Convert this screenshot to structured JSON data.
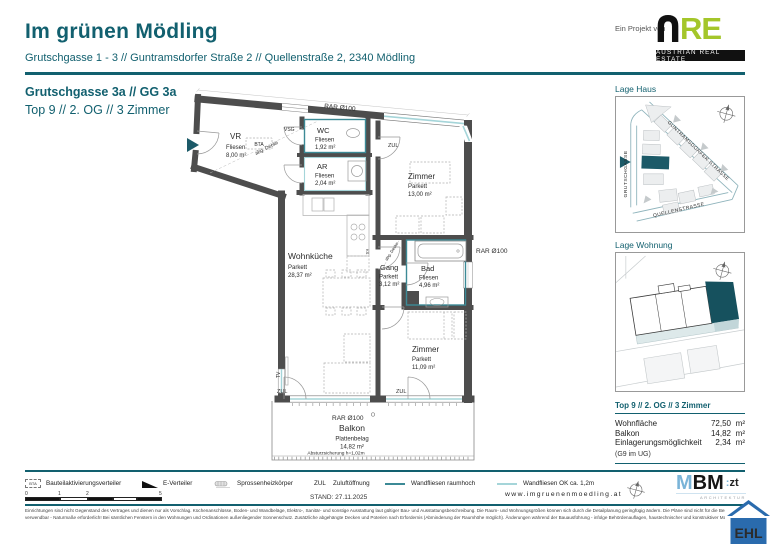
{
  "header": {
    "title": "Im grünen Mödling",
    "subtitle": "Grutschgasse 1 - 3 // Guntramsdorfer Straße 2 // Quellenstraße 2, 2340 Mödling",
    "project_note": "Ein Projekt von",
    "are_re": "RE",
    "are_caption": "AUSTRIAN REAL ESTATE"
  },
  "plan_header": {
    "address": "Grutschgasse 3a // GG 3a",
    "unit": "Top 9 // 2. OG // 3 Zimmer"
  },
  "floorplan": {
    "rooms": [
      {
        "name": "VR",
        "floor": "Fliesen",
        "area": "8,00 m²"
      },
      {
        "name": "WC",
        "floor": "Fliesen",
        "area": "1,92 m²"
      },
      {
        "name": "AR",
        "floor": "Fliesen",
        "area": "2,04 m²"
      },
      {
        "name": "Zimmer",
        "floor": "Parkett",
        "area": "13,00 m²"
      },
      {
        "name": "Wohnküche",
        "floor": "Parkett",
        "area": "28,37 m²"
      },
      {
        "name": "Gang",
        "floor": "Parkett",
        "area": "3,12 m²"
      },
      {
        "name": "Bad",
        "floor": "Fliesen",
        "area": "4,96 m²"
      },
      {
        "name": "Zimmer",
        "floor": "Parkett",
        "area": "11,09 m²"
      },
      {
        "name": "Balkon",
        "floor": "Plattenbelag",
        "area": "14,82 m²"
      }
    ],
    "labels": {
      "rar_top": "RAR Ø100",
      "rar_right": "RAR Ø100",
      "rar_balcony": "RAR Ø100",
      "vsg": "VSG",
      "bta": "BTA",
      "zul": "ZUL",
      "tv": "TV",
      "ks": "KS",
      "abg_decke": "abg. Decke",
      "absturz": "Absturzsicherung h=1,02m"
    }
  },
  "sidebar": {
    "lage_haus": {
      "title": "Lage Haus",
      "street_1": "GUNTRAMSDORFER STRASSE",
      "street_2": "GRUTSCHGASSE",
      "street_3": "QUELLENSTRASSE"
    },
    "lage_wohnung": {
      "title": "Lage Wohnung"
    },
    "unit_info": {
      "title": "Top 9 // 2. OG // 3 Zimmer",
      "rows": [
        {
          "label": "Wohnfläche",
          "value": "72,50",
          "unit": "m²"
        },
        {
          "label": "Balkon",
          "value": "14,82",
          "unit": "m²"
        },
        {
          "label": "Einlagerungsmöglichkeit",
          "value": "2,34",
          "unit": "m²"
        }
      ],
      "note": "(G9 im UG)"
    }
  },
  "footer": {
    "legend": [
      {
        "icon_text": "BTA",
        "label": "Bauteilaktivierungsverteiler"
      },
      {
        "label": "E-Verteiler"
      },
      {
        "label": "Sprossenheizkörper"
      },
      {
        "prefix": "ZUL",
        "label": "Zuluftöffnung"
      },
      {
        "label": "Wandfliesen raumhoch"
      },
      {
        "label": "Wandfliesen OK ca. 1,2m"
      }
    ],
    "scale": {
      "n0": "0",
      "n1": "1",
      "n2": "2",
      "n5": "5"
    },
    "stand": "STAND: 27.11.2025",
    "website": "www.imgruenenmoedling.at"
  },
  "logos": {
    "mbm": {
      "m": "M",
      "bm": "BM",
      "colon": ":",
      "zt": "zt",
      "sub": "ARCHITEKTUR"
    },
    "ehl": {
      "text": "EHL"
    }
  },
  "fine_print": {
    "line1": "Einrichtungen sind nicht Gegenstand des Vertrages und dienen nur als Vorschlag. Küchenanschlüsse, Boden- und Wandbeläge, Elektro-, Sanitär- und sonstige Ausstattung laut gültiger Bau- und Ausstattungsbeschreibung. Die Raum- und Wohnungsgrößen können sich durch die Detailplanung geringfügig ändern. Die Pläne sind nicht für die Bestellung von Einbaumöbeln",
    "line2": "verwendbar - Naturmaße erforderlich! Bei sämtlichen Fenstern in den Wohnungen und Ordinationen außenliegender Sonnenschutz. Zusätzliche abgehängte Decken und Poterien nach Erfordernis (Abminderung der Raumhöhe möglich). Änderungen während der Bauausführung - infolge Behördenauflagen, haustechnischer und konstruktiver Maßnahmen - vorbehalten."
  }
}
